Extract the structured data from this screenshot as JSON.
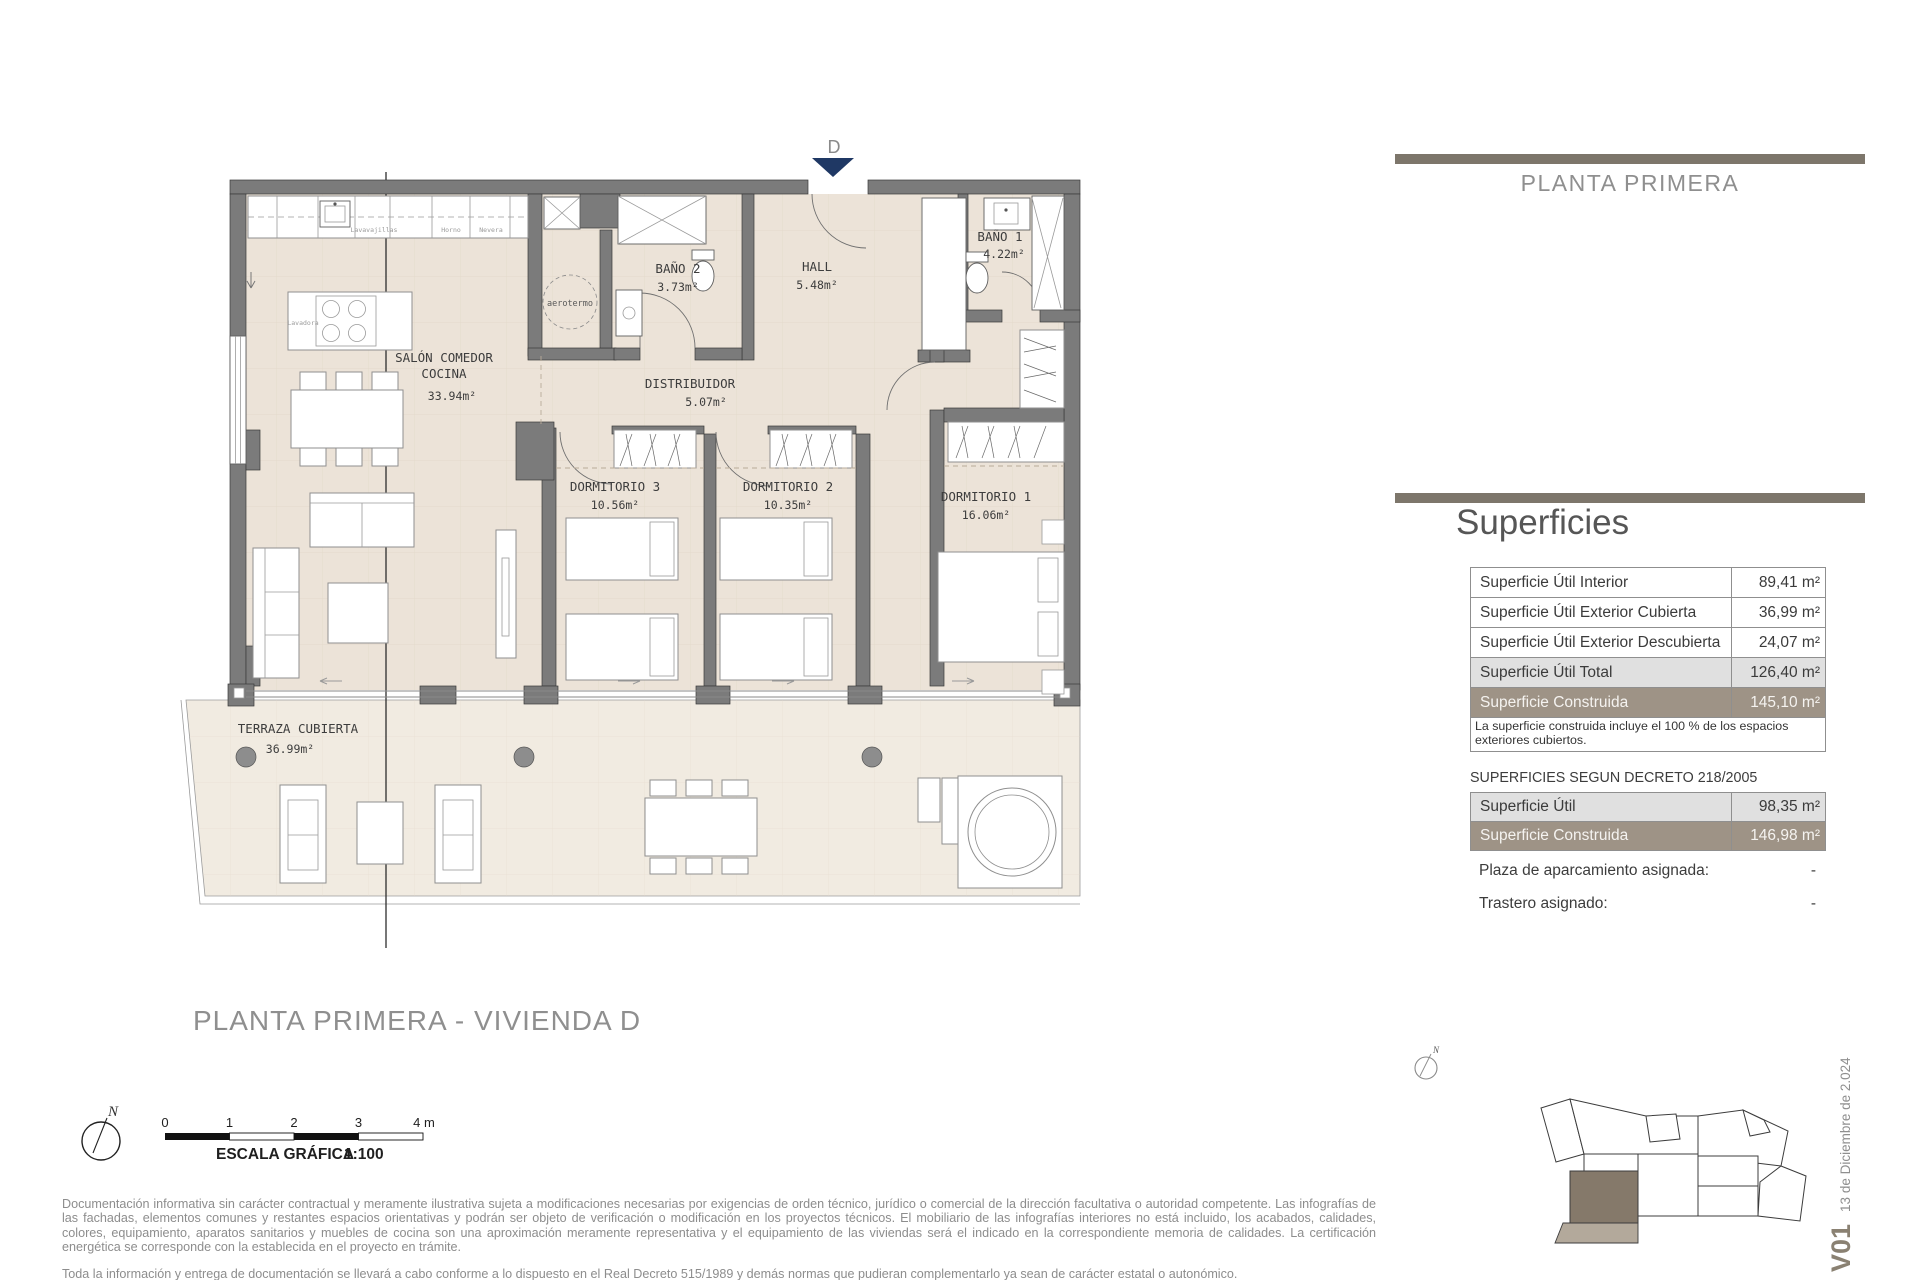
{
  "header": {
    "title": "PLANTA PRIMERA"
  },
  "colors": {
    "accent_bar": "#7d766b",
    "row_highlight": "#e0e0e0",
    "row_built": "#9e9386",
    "wall": "#7b7b7b",
    "floor": "#ece3d8",
    "terrace_floor": "#f1ebe1",
    "entry_arrow": "#1f3864",
    "siteplan_unit": "#85796a",
    "siteplan_terrace": "#b3a99b"
  },
  "superficies": {
    "title": "Superficies",
    "rows": [
      {
        "label": "Superficie Útil Interior",
        "value": "89,41",
        "unit": "m²"
      },
      {
        "label": "Superficie Útil Exterior Cubierta",
        "value": "36,99",
        "unit": "m²"
      },
      {
        "label": "Superficie Útil Exterior Descubierta",
        "value": "24,07",
        "unit": "m²"
      },
      {
        "label": "Superficie Útil Total",
        "value": "126,40",
        "unit": "m²"
      },
      {
        "label": "Superficie Construida",
        "value": "145,10",
        "unit": "m²"
      }
    ],
    "note": "La superficie construida incluye el 100 % de los espacios exteriores cubiertos."
  },
  "decreto": {
    "title": "SUPERFICIES SEGUN DECRETO 218/2005",
    "rows": [
      {
        "label": "Superficie Útil",
        "value": "98,35",
        "unit": "m²"
      },
      {
        "label": "Superficie Construida",
        "value": "146,98",
        "unit": "m²"
      }
    ],
    "assignments": [
      {
        "label": "Plaza de aparcamiento asignada:",
        "value": "-"
      },
      {
        "label": "Trastero asignado:",
        "value": "-"
      }
    ]
  },
  "plan": {
    "entry_label": "D",
    "rooms": {
      "salon": {
        "line1": "SALÓN COMEDOR",
        "line2": "COCINA",
        "area": "33.94m²"
      },
      "bano2": {
        "name": "BAÑO 2",
        "area": "3.73m²"
      },
      "hall": {
        "name": "HALL",
        "area": "5.48m²"
      },
      "bano1": {
        "name": "BAÑO 1",
        "area": "4.22m²"
      },
      "distribuidor": {
        "name": "DISTRIBUIDOR",
        "area": "5.07m²"
      },
      "dorm3": {
        "name": "DORMITORIO 3",
        "area": "10.56m²"
      },
      "dorm2": {
        "name": "DORMITORIO 2",
        "area": "10.35m²"
      },
      "dorm1": {
        "name": "DORMITORIO 1",
        "area": "16.06m²"
      },
      "terraza": {
        "name": "TERRAZA CUBIERTA",
        "area": "36.99m²"
      }
    },
    "labels": {
      "lavavajillas": "Lavavajillas",
      "horno": "Horno",
      "nevera": "Nevera",
      "lavadora": "Lavadora",
      "aerotermo": "aerotermo"
    }
  },
  "compass": {
    "label": "N"
  },
  "footer": {
    "title": "PLANTA PRIMERA - VIVIENDA D",
    "scale_ticks": [
      "0",
      "1",
      "2",
      "3",
      "4 m"
    ],
    "scale_label": "ESCALA GRÁFICA",
    "scale_ratio": "1:100",
    "disclaimer1": "Documentación informativa sin carácter contractual  y  meramente ilustrativa sujeta  a  modificaciones necesarias por exigencias de orden técnico, jurídico  o  comercial de la dirección facultativa  o  autoridad competente. Las infografías de las fachadas, elementos comunes y restantes espacios orientativas y podrán ser objeto de verificación o modificación en los proyectos técnicos. El mobiliario de las infografías interiores no está incluido, los  acabados,  calidades,  colores,  equipamiento,  aparatos sanitarios  y  muebles  de  cocina son una aproximación  meramente representativa  y  el equipamiento de  las viviendas será el indicado en la correspondiente memoria de calidades. La certificación energética se corresponde con la establecida en el proyecto en trámite.",
    "disclaimer2": "Toda la información y entrega de documentación se llevará a cabo conforme a lo dispuesto en el Real Decreto 515/1989 y demás normas que pudieran complementarlo ya sean de carácter estatal o autonómico."
  },
  "version": {
    "code": "V01",
    "date": "13 de Diciembre de 2.024"
  }
}
